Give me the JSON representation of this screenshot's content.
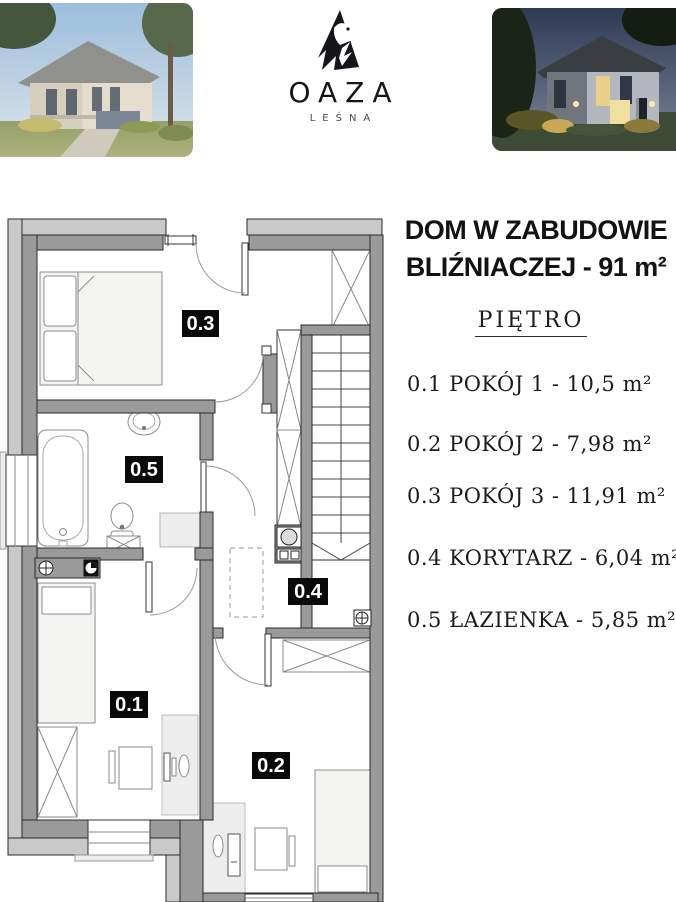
{
  "brand": {
    "name": "OAZA",
    "subtitle": "LEŚNA"
  },
  "title": {
    "line1": "DOM W ZABUDOWIE",
    "line2": "BLIŹNIACZEJ - 91 m²"
  },
  "floor_label": "PIĘTRO",
  "rooms": [
    {
      "id": "0.1",
      "list_label": "0.1 POKÓJ 1 - 10,5 m²"
    },
    {
      "id": "0.2",
      "list_label": "0.2 POKÓJ 2 - 7,98 m²"
    },
    {
      "id": "0.3",
      "list_label": "0.3 POKÓJ 3 - 11,91 m²"
    },
    {
      "id": "0.4",
      "list_label": "0.4 KORYTARZ - 6,04 m²"
    },
    {
      "id": "0.5",
      "list_label": "0.5 ŁAZIENKA - 5,85 m²"
    }
  ],
  "colors": {
    "wall_dark": "#9a9a9a",
    "wall_light": "#c9c9c9",
    "label_bg": "#0a0a0a",
    "label_text": "#ffffff"
  }
}
